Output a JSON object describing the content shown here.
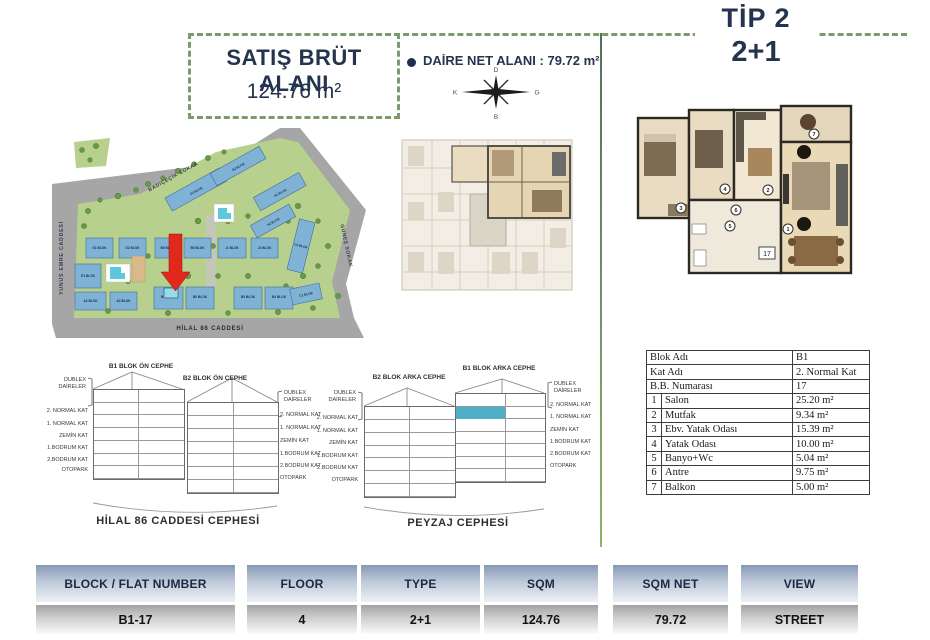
{
  "header": {
    "gross_area_title": "SATIŞ BRÜT ALANI",
    "gross_area_value": "124.76 m²",
    "net_area_text": "DAİRE NET ALANI : 79.72 m²",
    "type_title": "TİP 2",
    "type_variant": "2+1",
    "compass": {
      "top": "D",
      "right": "G",
      "bottom": "B",
      "left": "K"
    }
  },
  "site_plan": {
    "street_left": "YUNUS EMRE CADDESİ",
    "street_top": "BADIÇEÇİK SOKAK",
    "street_right": "GÜNEŞ SOKAK",
    "street_bottom": "HİLAL 86 CADDESİ",
    "blocks": [
      "G1 BLOK",
      "G2 BLOK",
      "B5 BLOK",
      "B6 BLOK",
      "J1 BLOK",
      "J2 BLOK",
      "E1 BLOK",
      "A2 BLOK",
      "A3 BLOK",
      "B1 BLOK",
      "B2 BLOK",
      "B3 BLOK",
      "B4 BLOK",
      "C1 BLOK",
      "C2 BLOK",
      "D1 BLOK",
      "D2 BLOK",
      "H1 BLOK",
      "H2 BLOK"
    ]
  },
  "unit_plan": {
    "room_numbers": [
      "1",
      "2",
      "3",
      "4",
      "5",
      "6",
      "7"
    ],
    "unit_number": "17"
  },
  "elevations": {
    "front": {
      "title_left": "B1 BLOK ÖN CEPHE",
      "title_right": "B2 BLOK ÖN CEPHE",
      "caption": "HİLAL 86 CADDESİ CEPHESİ"
    },
    "rear": {
      "title_left": "B2 BLOK ARKA CEPHE",
      "title_right": "B1 BLOK ARKA CEPHE",
      "caption": "PEYZAJ CEPHESİ"
    },
    "duplex_line1": "DUBLEX",
    "duplex_line2": "DAİRELER",
    "floors": [
      "2. NORMAL KAT",
      "1. NORMAL KAT",
      "ZEMİN KAT",
      "1.BODRUM KAT",
      "2.BODRUM KAT",
      "OTOPARK"
    ]
  },
  "detail_table": {
    "rows": [
      {
        "num": "",
        "label": "Blok Adı",
        "value": "B1"
      },
      {
        "num": "",
        "label": "Kat Adı",
        "value": "2. Normal Kat"
      },
      {
        "num": "",
        "label": "B.B. Numarası",
        "value": "17"
      },
      {
        "num": "1",
        "label": "Salon",
        "value": "25.20 m²"
      },
      {
        "num": "2",
        "label": "Mutfak",
        "value": "9.34 m²"
      },
      {
        "num": "3",
        "label": "Ebv. Yatak Odası",
        "value": "15.39 m²"
      },
      {
        "num": "4",
        "label": "Yatak Odası",
        "value": "10.00 m²"
      },
      {
        "num": "5",
        "label": "Banyo+Wc",
        "value": "5.04 m²"
      },
      {
        "num": "6",
        "label": "Antre",
        "value": "9.75 m²"
      },
      {
        "num": "7",
        "label": "Balkon",
        "value": "5.00 m²"
      }
    ]
  },
  "summary_table": {
    "columns": [
      {
        "header": "BLOCK / FLAT NUMBER",
        "value": "B1-17"
      },
      {
        "header": "FLOOR",
        "value": "4"
      },
      {
        "header": "TYPE",
        "value": "2+1"
      },
      {
        "header": "SQM",
        "value": "124.76"
      },
      {
        "header": "SQM NET",
        "value": "79.72"
      },
      {
        "header": "VIEW",
        "value": "STREET"
      }
    ]
  },
  "colors": {
    "navy": "#25344e",
    "dash_green": "#7d9a6e",
    "teal_highlight": "#4db0c6",
    "arrow_red": "#e2271c",
    "block_blue": "#7fb2d4",
    "map_green": "#b7d08d",
    "road_gray": "#a6a6a6"
  }
}
